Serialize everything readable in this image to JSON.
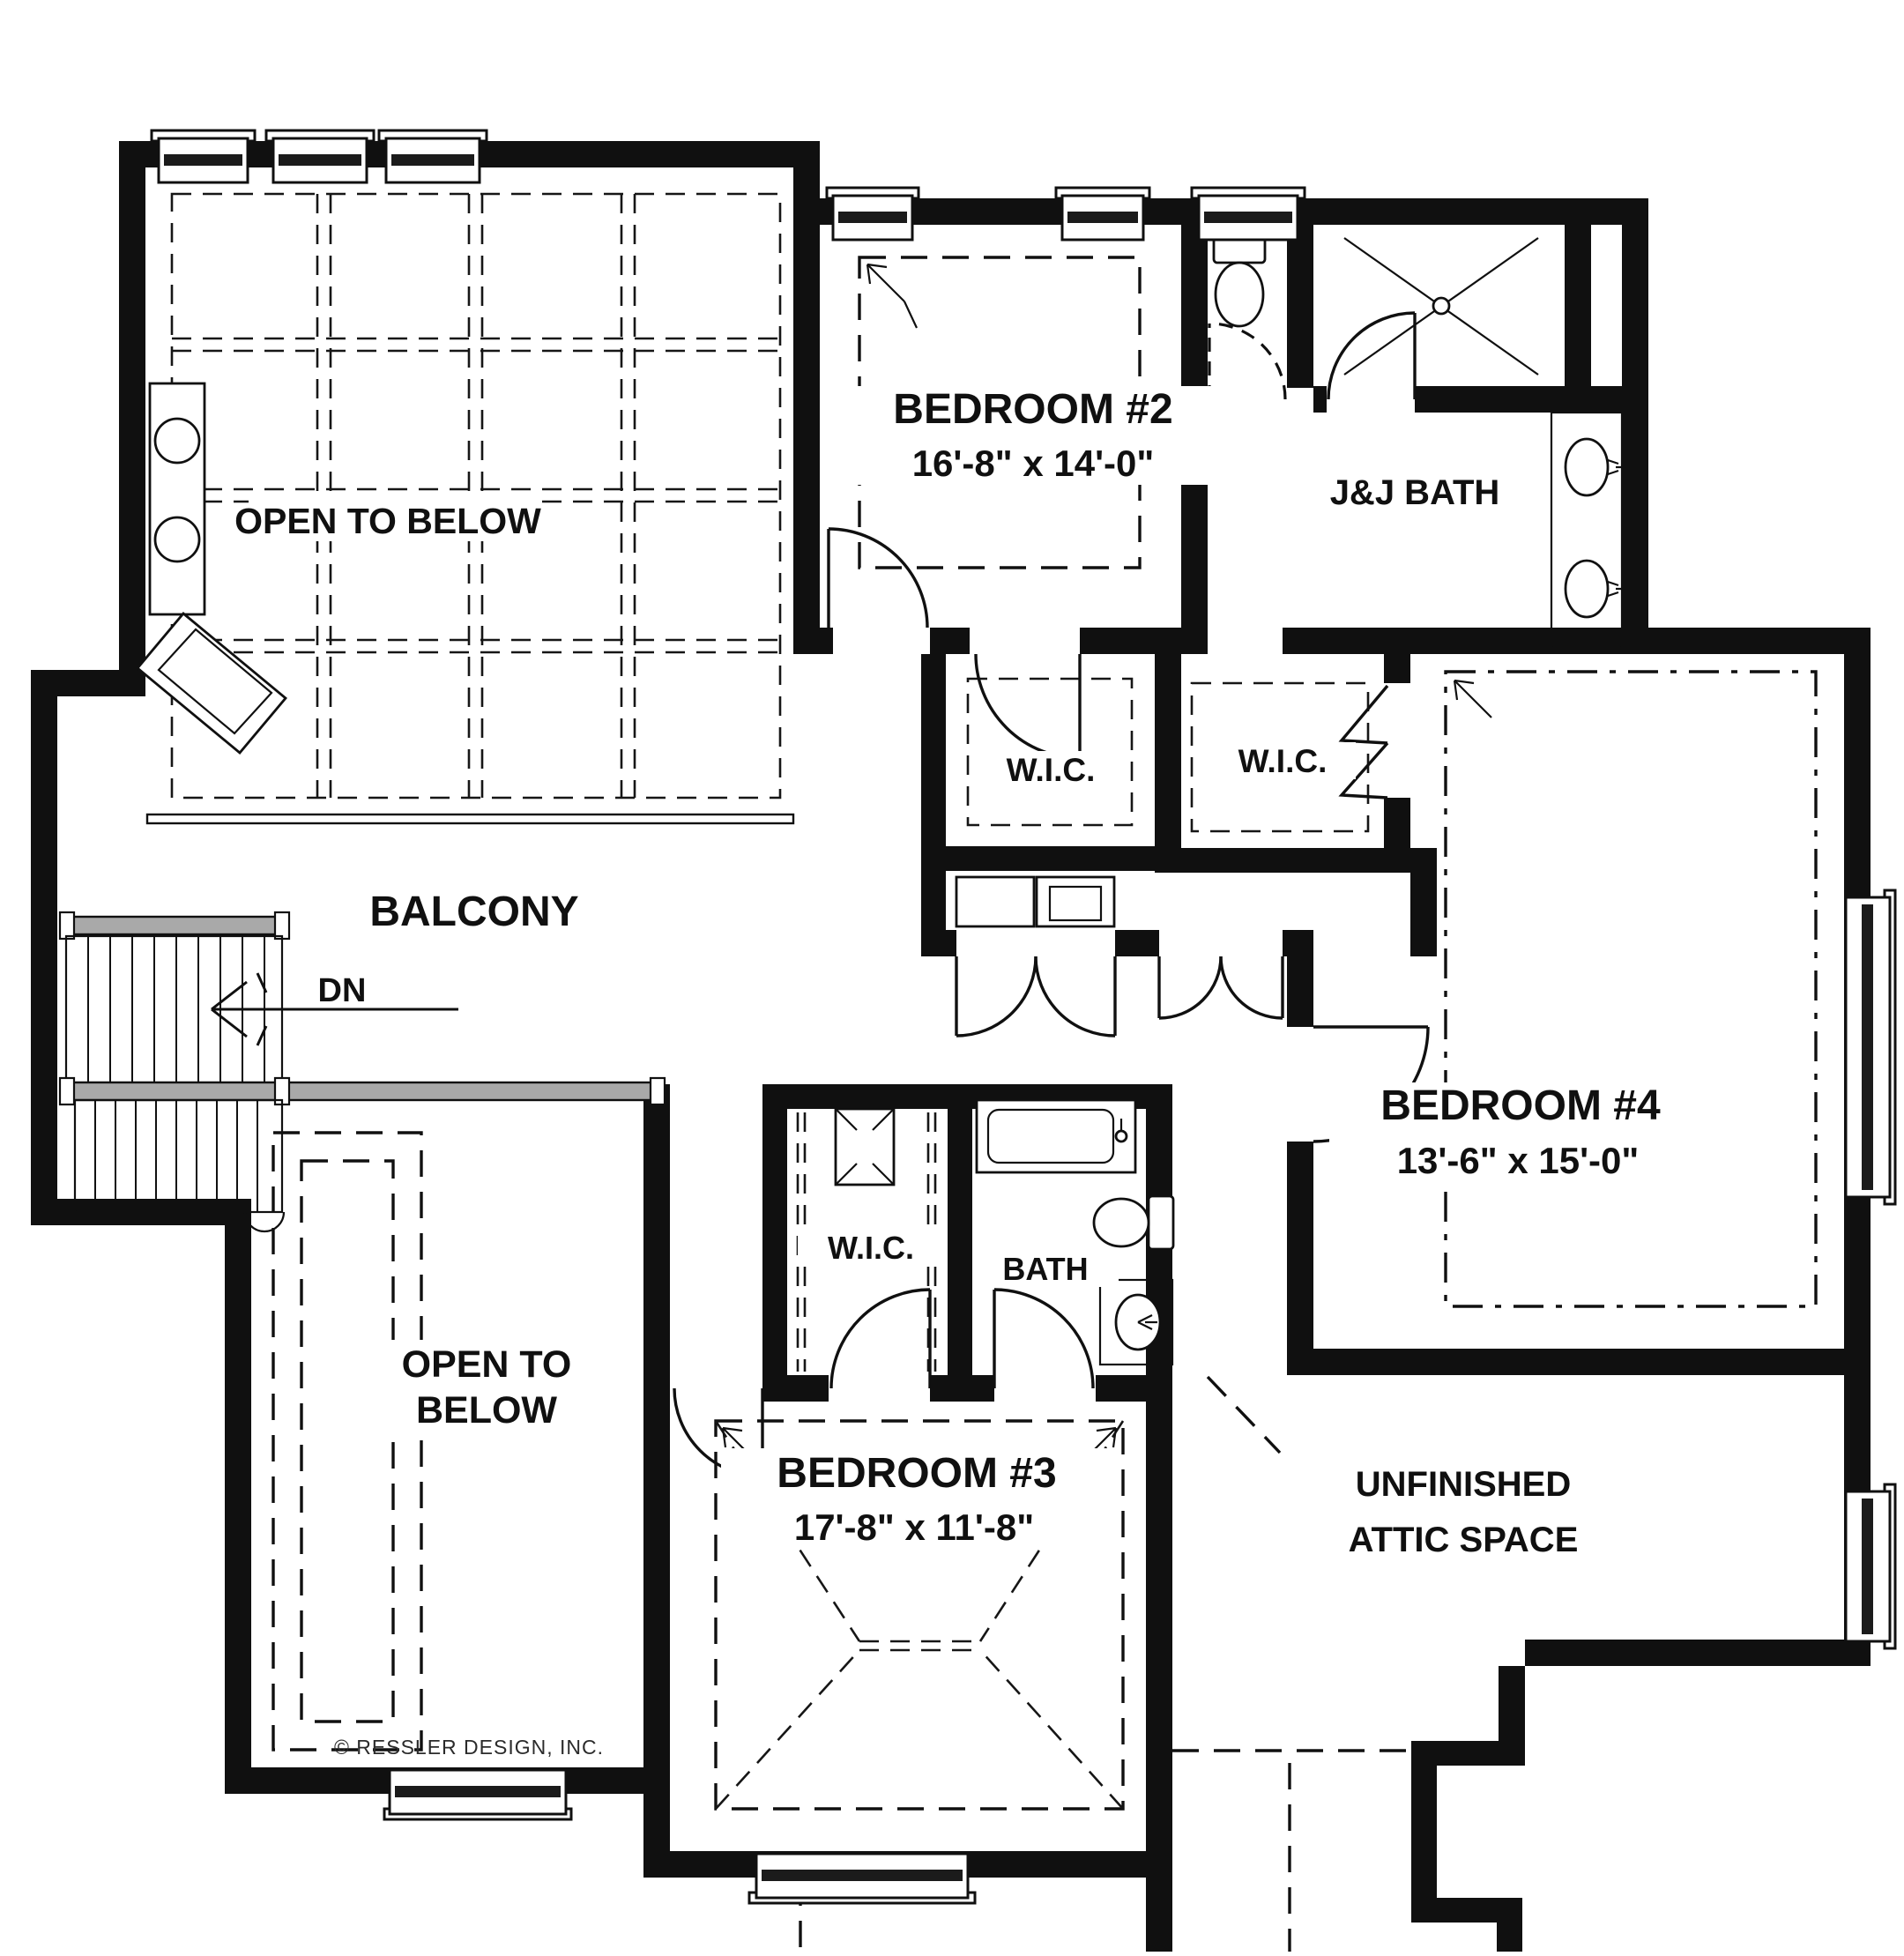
{
  "plan": {
    "rooms": {
      "open_to_below_upper": {
        "label": "OPEN TO BELOW"
      },
      "balcony": {
        "label": "BALCONY"
      },
      "stairs": {
        "direction_label": "DN"
      },
      "bedroom2": {
        "label": "BEDROOM #2",
        "dimensions": "16'-8\" x 14'-0\""
      },
      "jj_bath": {
        "label": "J&J BATH"
      },
      "wic_upper_left": {
        "label": "W.I.C."
      },
      "wic_upper_right": {
        "label": "W.I.C."
      },
      "bedroom4": {
        "label": "BEDROOM #4",
        "dimensions": "13'-6\" x 15'-0\""
      },
      "wic_lower": {
        "label": "W.I.C."
      },
      "bath": {
        "label": "BATH"
      },
      "open_to_below_lower": {
        "label_line1": "OPEN TO",
        "label_line2": "BELOW"
      },
      "bedroom3": {
        "label": "BEDROOM #3",
        "dimensions": "17'-8\" x 11'-8\""
      },
      "attic": {
        "label_line1": "UNFINISHED",
        "label_line2": "ATTIC SPACE"
      }
    },
    "credit": "© RESSLER DESIGN, INC.",
    "colors": {
      "ink": "#101010",
      "background": "#ffffff",
      "railing": "#a9a9a9",
      "glass": "#1b1b1b"
    }
  }
}
